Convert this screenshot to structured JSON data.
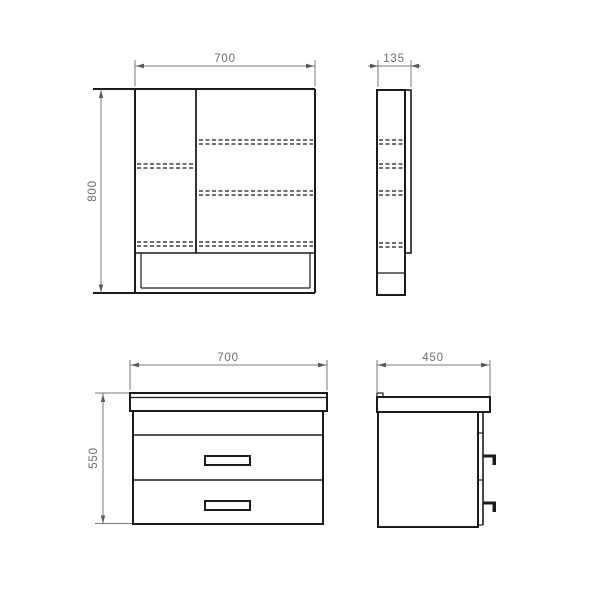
{
  "drawing": {
    "kind": "orthographic technical drawing",
    "colors": {
      "outline": "#1b1b1b",
      "dimension": "#7a7a7a",
      "hidden_edge": "#3f3f3f",
      "background": "#ffffff"
    },
    "mirror_cabinet": {
      "front_view": {
        "width_label": "700",
        "height_label": "800"
      },
      "side_view": {
        "depth_label": "135"
      }
    },
    "vanity_unit": {
      "front_view": {
        "width_label": "700",
        "height_label": "550"
      },
      "side_view": {
        "depth_label": "450"
      }
    }
  }
}
